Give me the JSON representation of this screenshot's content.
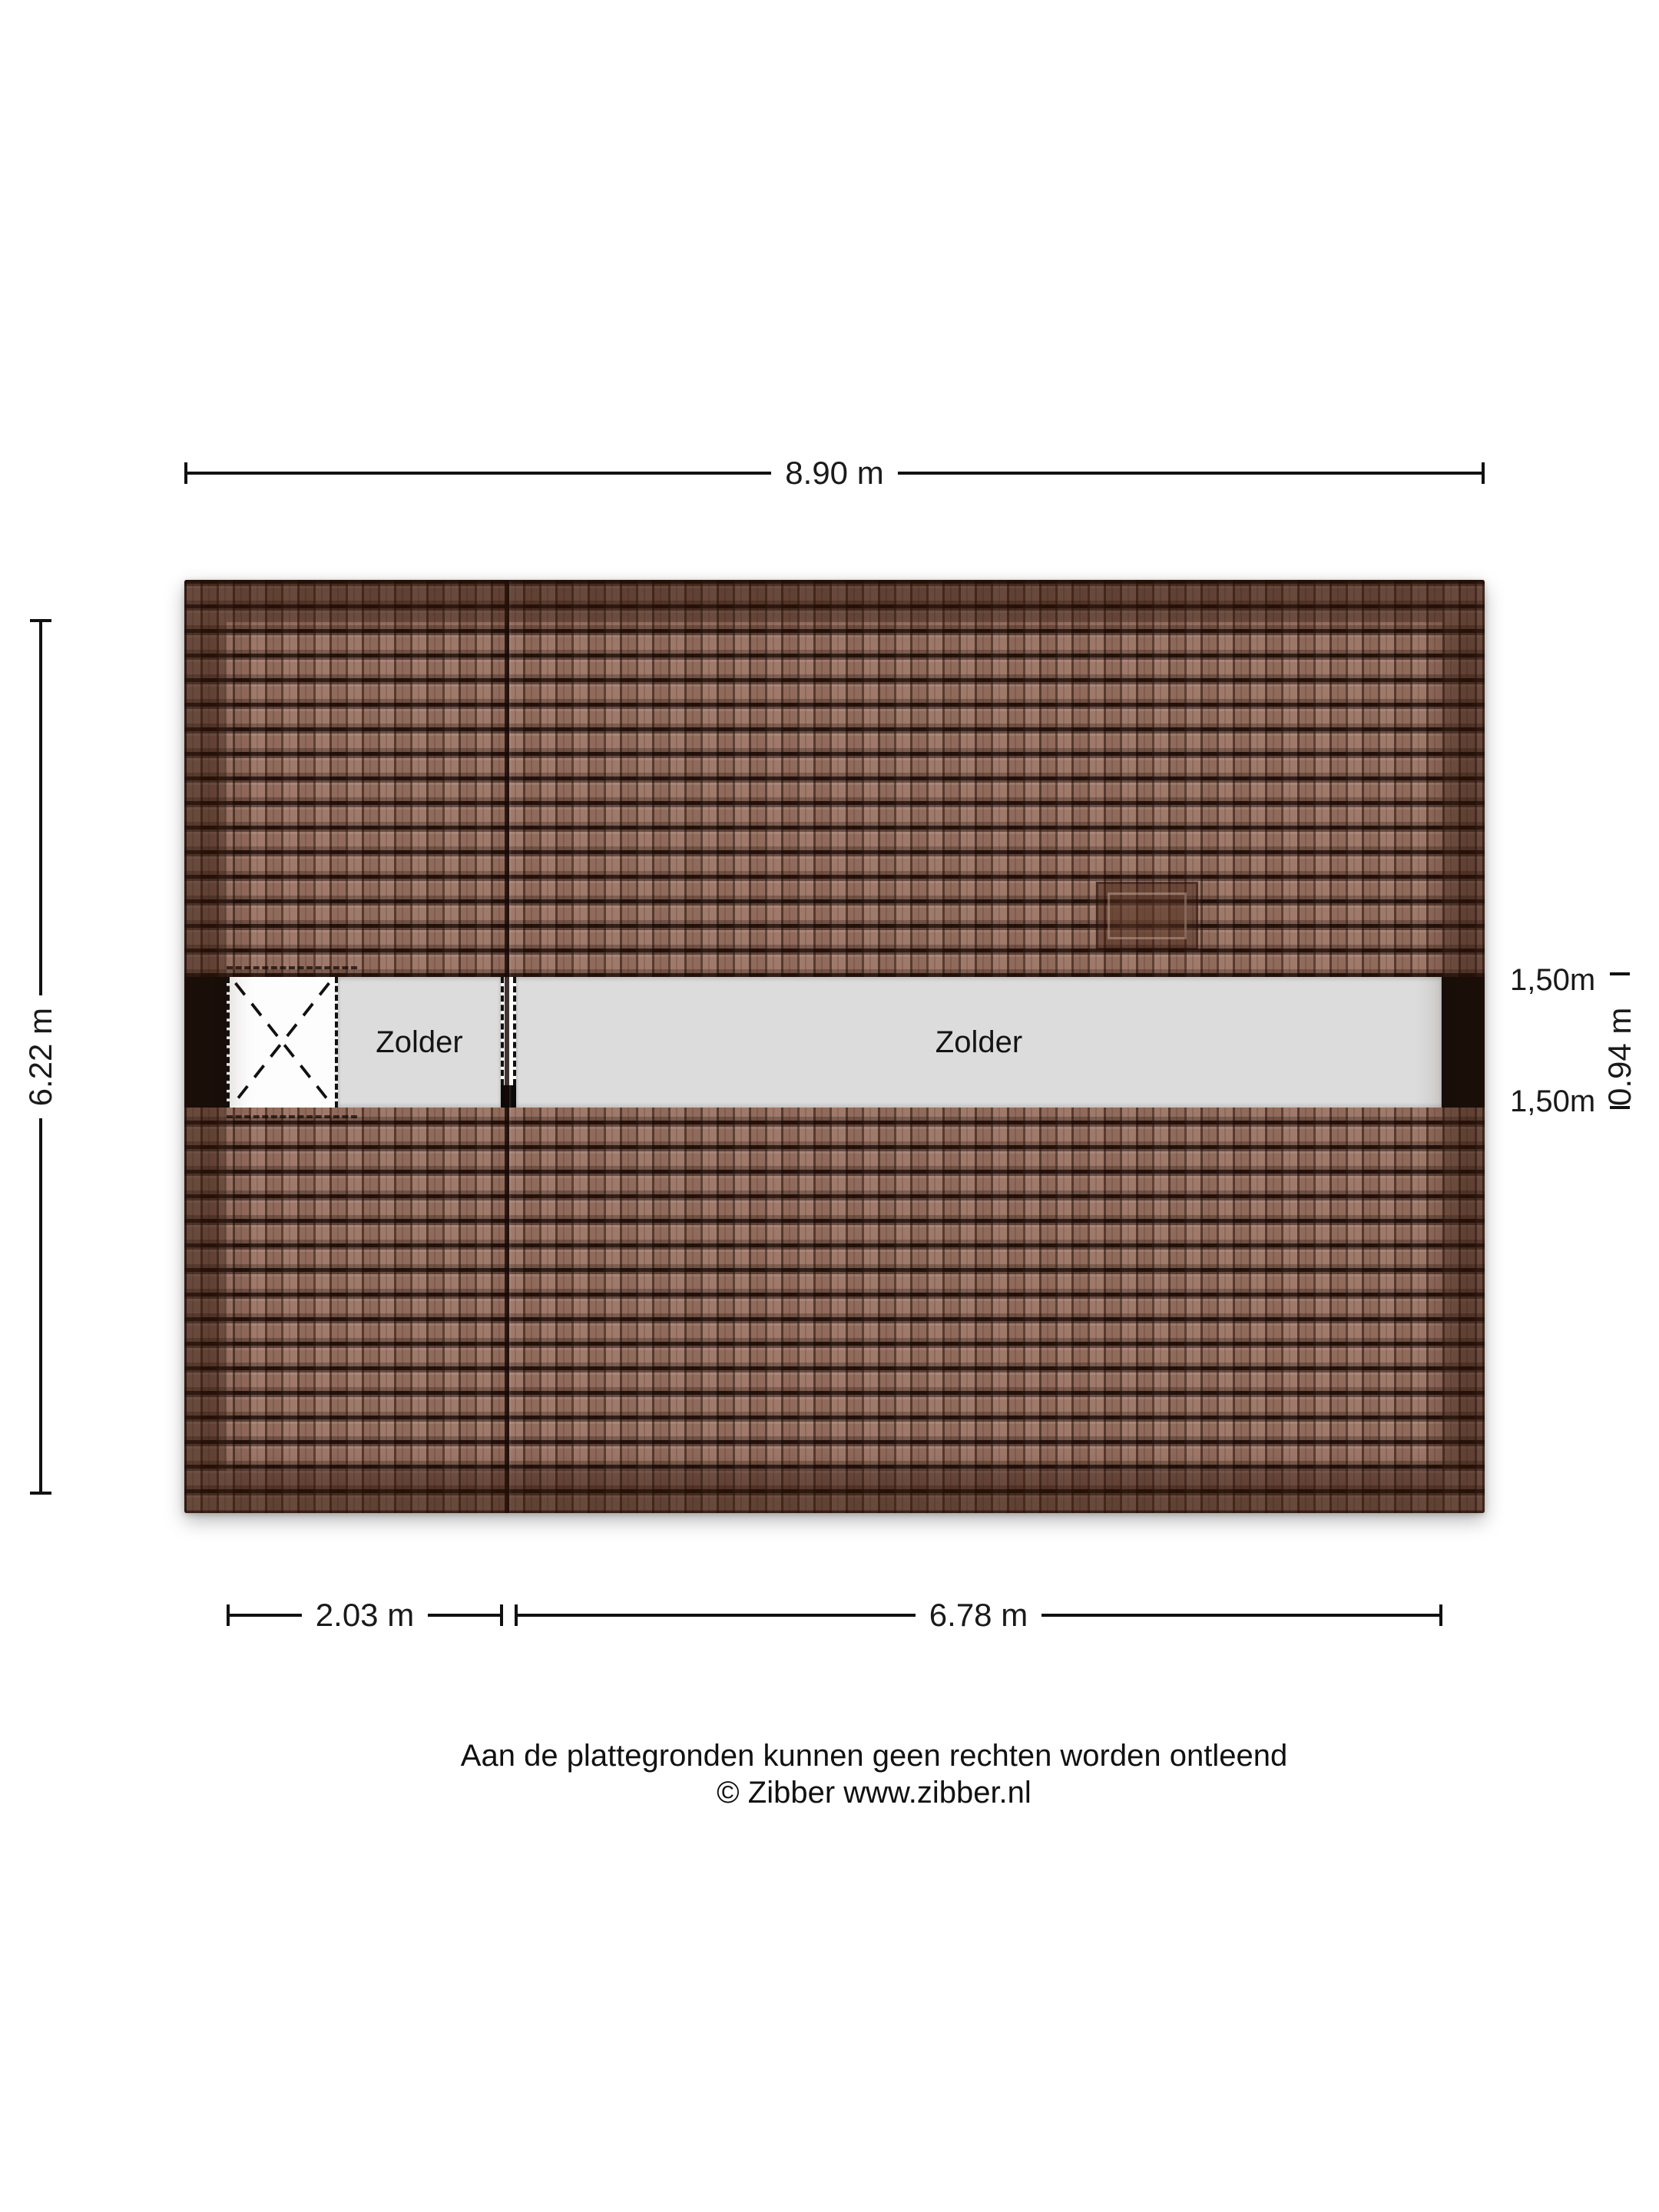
{
  "plan": {
    "rooms": {
      "zolder_small": {
        "label": "Zolder"
      },
      "zolder_large": {
        "label": "Zolder"
      }
    },
    "dimensions": {
      "top_width": {
        "label": "8.90 m"
      },
      "left_depth": {
        "label": "6.22 m"
      },
      "right_upper": {
        "label": "1,50m"
      },
      "right_middle": {
        "label": "0.94 m"
      },
      "right_lower": {
        "label": "1,50m"
      },
      "bottom_left": {
        "label": "2.03 m"
      },
      "bottom_right": {
        "label": "6.78 m"
      }
    }
  },
  "footer": {
    "disclaimer": "Aan de plattegronden kunnen geen rechten worden ontleend",
    "copyright": "© Zibber www.zibber.nl"
  },
  "colors": {
    "background": "#ffffff",
    "roof_tile": "#9a7161",
    "roof_tile_gap": "#2f1b13",
    "roof_rim_shade": "#5e4034",
    "floor_gray": "#dcdcdc",
    "wall_black": "#0a0a0a",
    "text": "#1a1a1a"
  }
}
